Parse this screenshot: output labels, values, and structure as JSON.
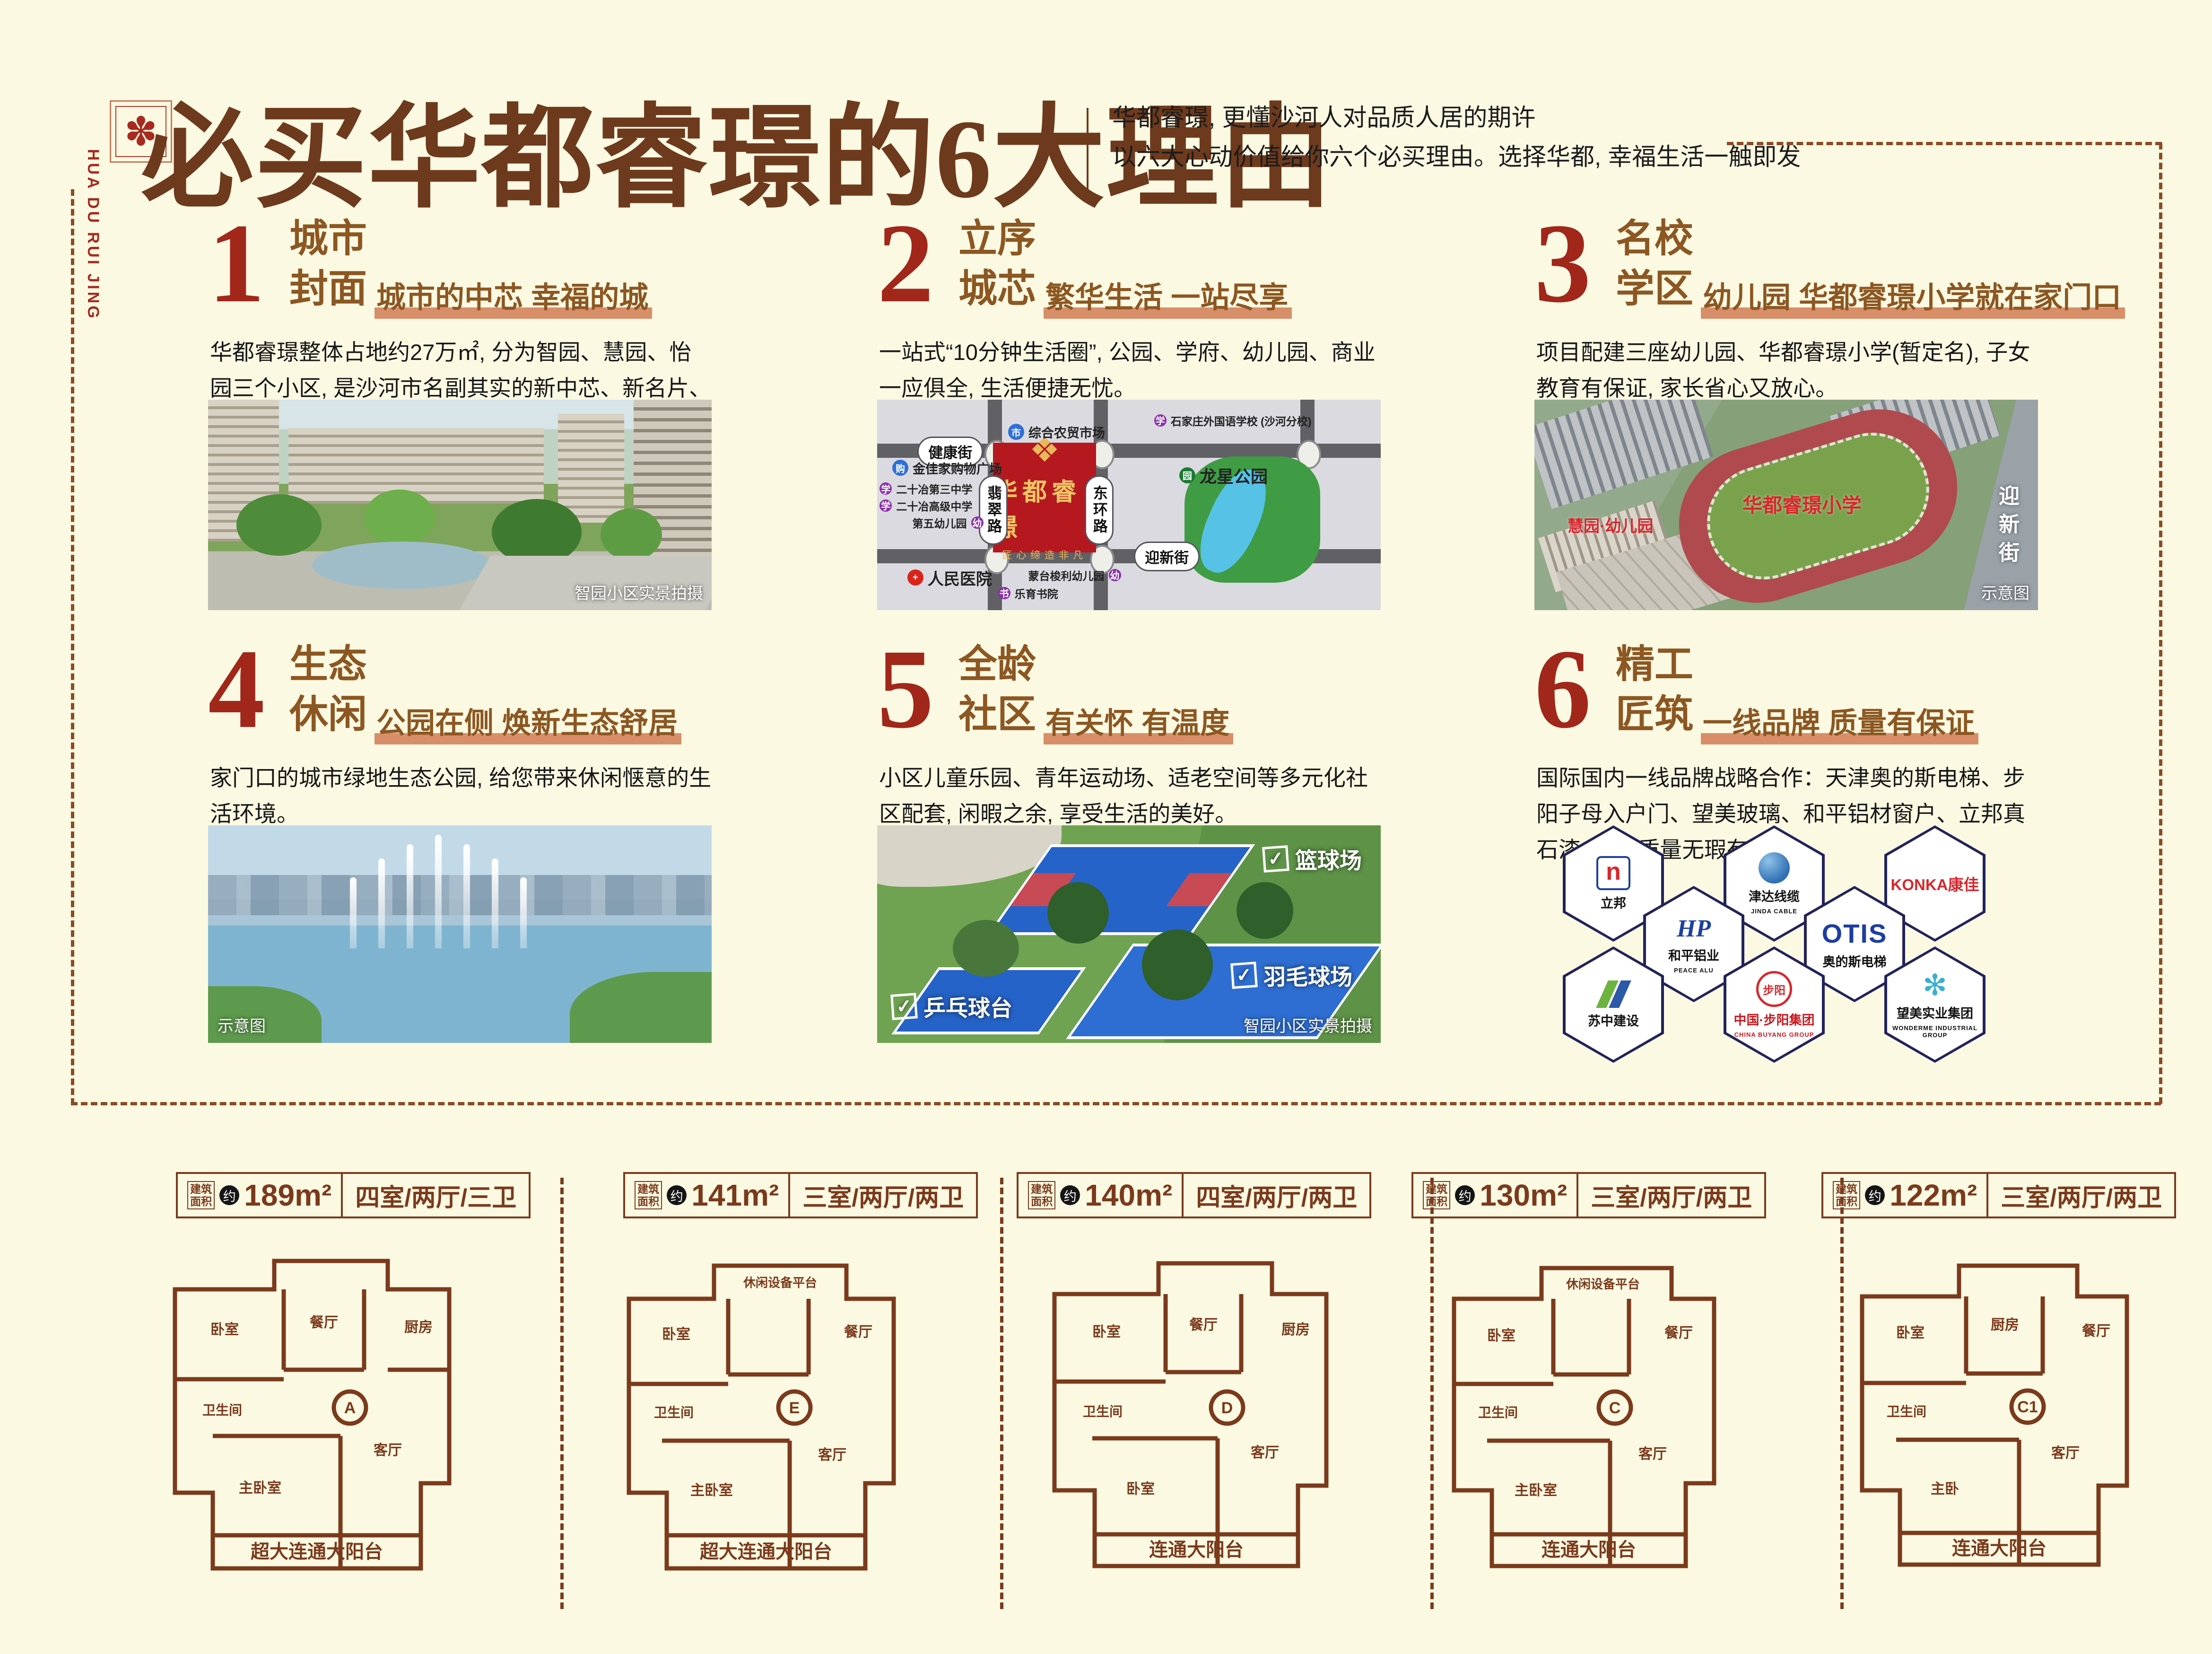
{
  "page": {
    "background": "#FCF9E3",
    "accent_red": "#A1271B",
    "section_brown": "#8C5722",
    "title_brown": "#6E3A1D",
    "underline_salmon": "#D88F69",
    "plan_brown": "#7B3A1C"
  },
  "header": {
    "logo_glyph": "✽",
    "logo_text": "HUA DU RUI JING",
    "title": "必买华都睿璟的6大理由",
    "subtitle_line1": "华都睿璟, 更懂沙河人对品质人居的期许",
    "subtitle_line2": "以六大心动价值给你六个必买理由。选择华都, 幸福生活一触即发"
  },
  "sections": [
    {
      "num": "1",
      "title1": "城市",
      "title2": "封面",
      "tagline": "城市的中芯 幸福的城",
      "body": "华都睿璟整体占地约27万㎡, 分为智园、慧园、怡园三个小区, 是沙河市名副其实的新中芯、新名片、新封面。",
      "caption": "智园小区实景拍摄"
    },
    {
      "num": "2",
      "title1": "立序",
      "title2": "城芯",
      "tagline": "繁华生活 一站尽享",
      "body": "一站式“10分钟生活圈”, 公园、学府、幼儿园、商业一应俱全, 生活便捷无忧。"
    },
    {
      "num": "3",
      "title1": "名校",
      "title2": "学区",
      "tagline": "幼儿园 华都睿璟小学就在家门口",
      "body": "项目配建三座幼儿园、华都睿璟小学(暂定名), 子女教育有保证, 家长省心又放心。",
      "caption": "示意图",
      "label_school": "华都睿璟小学",
      "label_kindergarten": "慧园·幼儿园",
      "label_road": "迎新街"
    },
    {
      "num": "4",
      "title1": "生态",
      "title2": "休闲",
      "tagline": "公园在侧 焕新生态舒居",
      "body": "家门口的城市绿地生态公园, 给您带来休闲惬意的生活环境。",
      "caption": "示意图"
    },
    {
      "num": "5",
      "title1": "全龄",
      "title2": "社区",
      "tagline": "有关怀 有温度",
      "body": "小区儿童乐园、青年运动场、适老空间等多元化社区配套, 闲暇之余, 享受生活的美好。",
      "caption": "智园小区实景拍摄",
      "label_basketball": "篮球场",
      "label_badminton": "羽毛球场",
      "label_pingpong": "乒乓球台",
      "check_glyph": "✓"
    },
    {
      "num": "6",
      "title1": "精工",
      "title2": "匠筑",
      "tagline": "一线品牌 质量有保证",
      "body": "国际国内一线品牌战略合作：天津奥的斯电梯、步阳子母入户门、望美玻璃、和平铝材窗户、立邦真石漆, 房子质量无瑕有保证。"
    }
  ],
  "map": {
    "project": "华都睿璟",
    "emblem_glyph": "❖",
    "slogan": "匠心缔造非凡",
    "roads": {
      "h1": "健康街",
      "h2": "迎新街",
      "v1": "翡翠路",
      "v2": "东环路"
    },
    "pois": [
      {
        "name": "综合农贸市场",
        "color": "#2E6FD8",
        "glyph": "市"
      },
      {
        "name": "石家庄外国语学校 (沙河分校)",
        "color": "#8B2FA8",
        "glyph": "学"
      },
      {
        "name": "金佳家购物广场",
        "color": "#2E6FD8",
        "glyph": "购"
      },
      {
        "name": "二十冶第三中学",
        "color": "#8B2FA8",
        "glyph": "学"
      },
      {
        "name": "二十冶高级中学",
        "color": "#8B2FA8",
        "glyph": "学"
      },
      {
        "name": "第五幼儿园",
        "color": "#8B2FA8",
        "glyph": "幼"
      },
      {
        "name": "人民医院",
        "color": "#D8251C",
        "glyph": "+"
      },
      {
        "name": "蒙台梭利幼儿园",
        "color": "#8B2FA8",
        "glyph": "幼"
      },
      {
        "name": "乐育书院",
        "color": "#8B2FA8",
        "glyph": "书"
      },
      {
        "name": "龙星公园",
        "color": "#1E7A33",
        "glyph": "园"
      }
    ]
  },
  "brands": [
    {
      "cn": "立邦",
      "en": "",
      "glyph": "n"
    },
    {
      "cn": "津达线缆",
      "en": "JINDA CABLE",
      "glyph": ""
    },
    {
      "cn": "KONKA康佳",
      "en": "",
      "glyph": ""
    },
    {
      "cn": "和平铝业",
      "en": "PEACE ALU",
      "glyph": "HP"
    },
    {
      "cn": "奥的斯电梯",
      "en": "OTIS",
      "glyph": "OTIS"
    },
    {
      "cn": "苏中建设",
      "en": "",
      "glyph": ""
    },
    {
      "cn": "中国·步阳集团",
      "en": "CHINA BUYANG GROUP",
      "glyph": "步阳"
    },
    {
      "cn": "望美实业集团",
      "en": "WONDERME INDUSTRIAL GROUP",
      "glyph": "✻"
    }
  ],
  "floorplans": [
    {
      "area_label": "建筑面积",
      "approx": "约",
      "area": "189m²",
      "layout": "四室/两厅/三卫",
      "unit": "A",
      "balcony": "超大连通大阳台",
      "rooms": [
        "卧室",
        "餐厅",
        "厨房",
        "卫生间",
        "客厅",
        "主卧室"
      ]
    },
    {
      "area_label": "建筑面积",
      "approx": "约",
      "area": "141m²",
      "layout": "三室/两厅/两卫",
      "unit": "E",
      "balcony": "超大连通大阳台",
      "rooms": [
        "卧室",
        "休闲设备平台",
        "餐厅",
        "卫生间",
        "客厅",
        "主卧室"
      ]
    },
    {
      "area_label": "建筑面积",
      "approx": "约",
      "area": "140m²",
      "layout": "四室/两厅/两卫",
      "unit": "D",
      "balcony": "连通大阳台",
      "rooms": [
        "卧室",
        "餐厅",
        "厨房",
        "卫生间",
        "客厅",
        "卧室"
      ]
    },
    {
      "area_label": "建筑面积",
      "approx": "约",
      "area": "130m²",
      "layout": "三室/两厅/两卫",
      "unit": "C",
      "balcony": "连通大阳台",
      "rooms": [
        "卧室",
        "休闲设备平台",
        "餐厅",
        "卫生间",
        "客厅",
        "主卧室"
      ]
    },
    {
      "area_label": "建筑面积",
      "approx": "约",
      "area": "122m²",
      "layout": "三室/两厅/两卫",
      "unit": "C1",
      "balcony": "连通大阳台",
      "rooms": [
        "卧室",
        "厨房",
        "餐厅",
        "卫生间",
        "客厅",
        "主卧"
      ]
    }
  ]
}
